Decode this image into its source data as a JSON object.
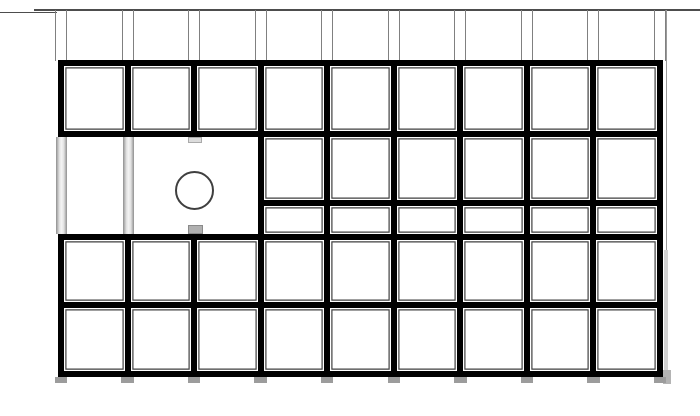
{
  "drawing": {
    "title": "panel-grid-elevation",
    "canvas": {
      "width": 700,
      "height": 416,
      "background": "#ffffff"
    },
    "colors": {
      "border_black": "#000000",
      "cell_fill": "#ffffff",
      "inner_line": "#3f3f3f",
      "inner_gap": "#ffffff",
      "top_line": "#4d4d4d",
      "guide_gray": "#808080",
      "edge_line": "#9a9a9a",
      "bar_dark": "#8f8f8f",
      "bar_mid": "#e0e0e0",
      "bar_light": "#f4f4f4",
      "circle_stroke": "#3f3f3f",
      "tab_top_fill": "#dcdcdc",
      "tab_top_edge": "#aaaaaa",
      "tab_bottom_fill": "#b0b0b0",
      "tab_bottom_edge": "#8a8a8a",
      "foot_fill": "#9c9c9c",
      "shadow": "#b4b4b4",
      "shadow_soft": "#d2d2d2"
    },
    "top_lines": [
      {
        "x": 0,
        "y": 11.6,
        "w": 57,
        "h": 1.4
      },
      {
        "x": 34,
        "y": 9.2,
        "w": 666,
        "h": 1.7
      }
    ],
    "grid": {
      "left": 58,
      "right": 663,
      "top": 60,
      "bottom": 377,
      "columns": 9,
      "border_half": 3,
      "joint_centers": [
        61,
        127.6,
        194.1,
        260.7,
        327.2,
        393.8,
        460.3,
        526.9,
        593.4,
        660
      ]
    },
    "black_regions": [
      {
        "id": "upper-strip",
        "x": 58,
        "y": 60,
        "w": 605,
        "h": 77
      },
      {
        "id": "mid-right-strip",
        "x": 257.7,
        "y": 137,
        "w": 405.3,
        "h": 97
      },
      {
        "id": "lower-strip",
        "x": 58,
        "y": 234,
        "w": 605,
        "h": 143
      }
    ],
    "cell_rows": [
      {
        "id": "row1",
        "y": 66,
        "h": 65,
        "col_start": 0,
        "col_end": 8
      },
      {
        "id": "row2a",
        "y": 137,
        "h": 63,
        "col_start": 3,
        "col_end": 8
      },
      {
        "id": "row2b",
        "y": 206,
        "h": 28,
        "col_start": 3,
        "col_end": 8
      },
      {
        "id": "row3",
        "y": 240,
        "h": 62,
        "col_start": 0,
        "col_end": 8
      },
      {
        "id": "row4",
        "y": 308,
        "h": 63,
        "col_start": 0,
        "col_end": 8
      }
    ],
    "guides": {
      "y_top": 10,
      "y_bottom": 61,
      "half_gap": 5.5,
      "thickness": 1.1
    },
    "edge_guide": {
      "x": 666.2,
      "y": 10,
      "h": 367,
      "thickness": 1.1
    },
    "column_bars": [
      {
        "x": 55.5,
        "y": 137,
        "w": 11.5,
        "h": 97
      },
      {
        "x": 122.5,
        "y": 137,
        "w": 11.5,
        "h": 97
      }
    ],
    "circle": {
      "cx": 194,
      "cy": 190,
      "r": 19.5,
      "stroke_w": 2
    },
    "tabs": [
      {
        "id": "tab-top",
        "x": 187.5,
        "y": 137,
        "w": 14,
        "h": 5.5,
        "fill": "tab_top_fill",
        "edge": "tab_top_edge"
      },
      {
        "id": "tab-bottom",
        "x": 187.5,
        "y": 224.5,
        "w": 15.5,
        "h": 9,
        "fill": "tab_bottom_fill",
        "edge": "tab_bottom_edge"
      }
    ],
    "feet": {
      "y": 376.5,
      "w": 12.5,
      "h": 6
    },
    "shadows": [
      {
        "x": 663.5,
        "y": 250,
        "w": 4,
        "h": 127,
        "color_key": "shadow_soft"
      },
      {
        "x": 663,
        "y": 370,
        "w": 7.5,
        "h": 14,
        "color_key": "shadow"
      }
    ]
  }
}
